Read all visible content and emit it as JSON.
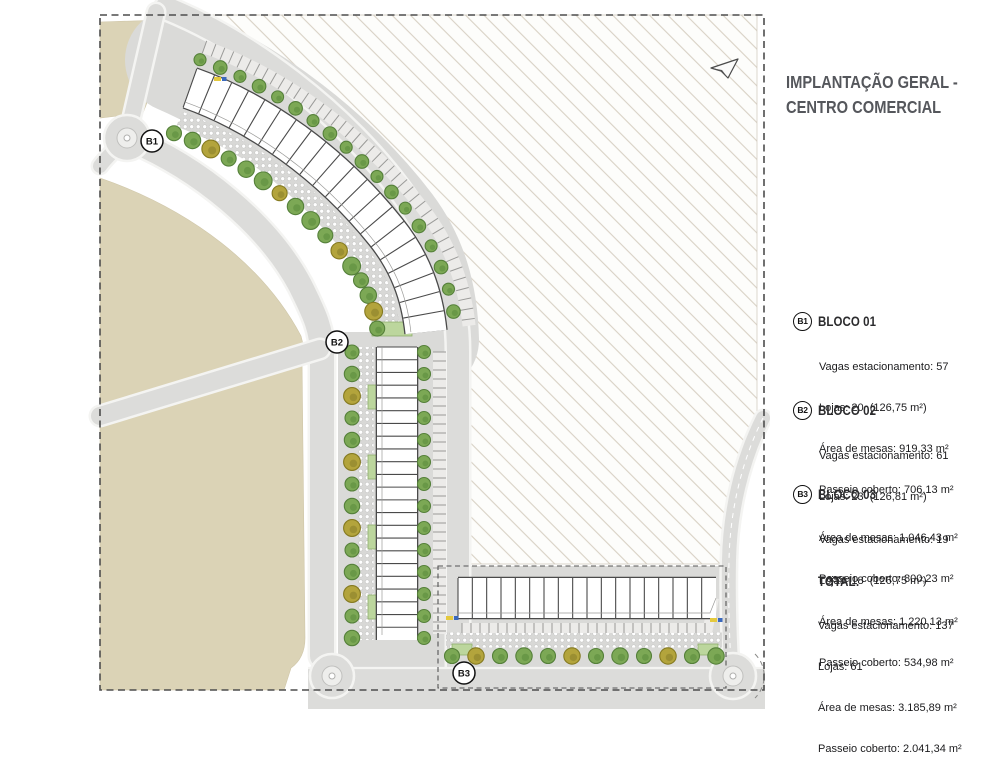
{
  "title": {
    "line1": "IMPLANTAÇÃO GERAL -",
    "line2": "CENTRO COMERCIAL"
  },
  "legend": {
    "blocks": [
      {
        "badge": "B1",
        "name": "BLOCO 01",
        "lines": [
          "Vagas estacionamento: 57",
          "Lojas: 20  (126,75 m²)",
          "Área de mesas: 919,33 m²",
          "Passeio coberto: 706,13 m²"
        ]
      },
      {
        "badge": "B2",
        "name": "BLOCO 02",
        "lines": [
          "Vagas estacionamento: 61",
          "Lojas: 23  (126,81 m²)",
          "Área de mesas: 1.046,43 m²",
          "Passeio coberto: 800,23 m²"
        ]
      },
      {
        "badge": "B3",
        "name": "BLOCO 03",
        "lines": [
          "Vagas estacionamento: 19",
          "Lojas: 18  (126,75 m²)",
          "Área de mesas: 1.220,13 m²",
          "Passeio coberto: 534,98 m²"
        ]
      }
    ],
    "total": {
      "name": "TOTAL:",
      "lines": [
        "Vagas estacionamento: 137",
        "Lojas: 61",
        "Área de mesas: 3.185,89 m²",
        "Passeio coberto: 2.041,34 m²"
      ]
    }
  },
  "map": {
    "badges": [
      {
        "label": "B1",
        "x": 152,
        "y": 141
      },
      {
        "label": "B2",
        "x": 337,
        "y": 342
      },
      {
        "label": "B3",
        "x": 464,
        "y": 673
      }
    ],
    "blocks": [
      {
        "id": "B1",
        "shops": 20
      },
      {
        "id": "B2",
        "shops": 23
      },
      {
        "id": "B3",
        "shops": 18
      }
    ],
    "colors": {
      "terrain": "#dbd3b6",
      "terrain_edge": "#cfc6a8",
      "road": "#dcdcda",
      "road_casing": "#f4f4f2",
      "hatch_line": "#d8d1c5",
      "building_outline": "#4a4a4a",
      "tree_green": "#7ca855",
      "tree_green_dark": "#55803a",
      "tree_olive": "#b3a43c",
      "tree_olive_dark": "#857a20",
      "planter": "#bcd69d",
      "planter_edge": "#8fae6d",
      "boundary": "#4d4d4d"
    }
  }
}
